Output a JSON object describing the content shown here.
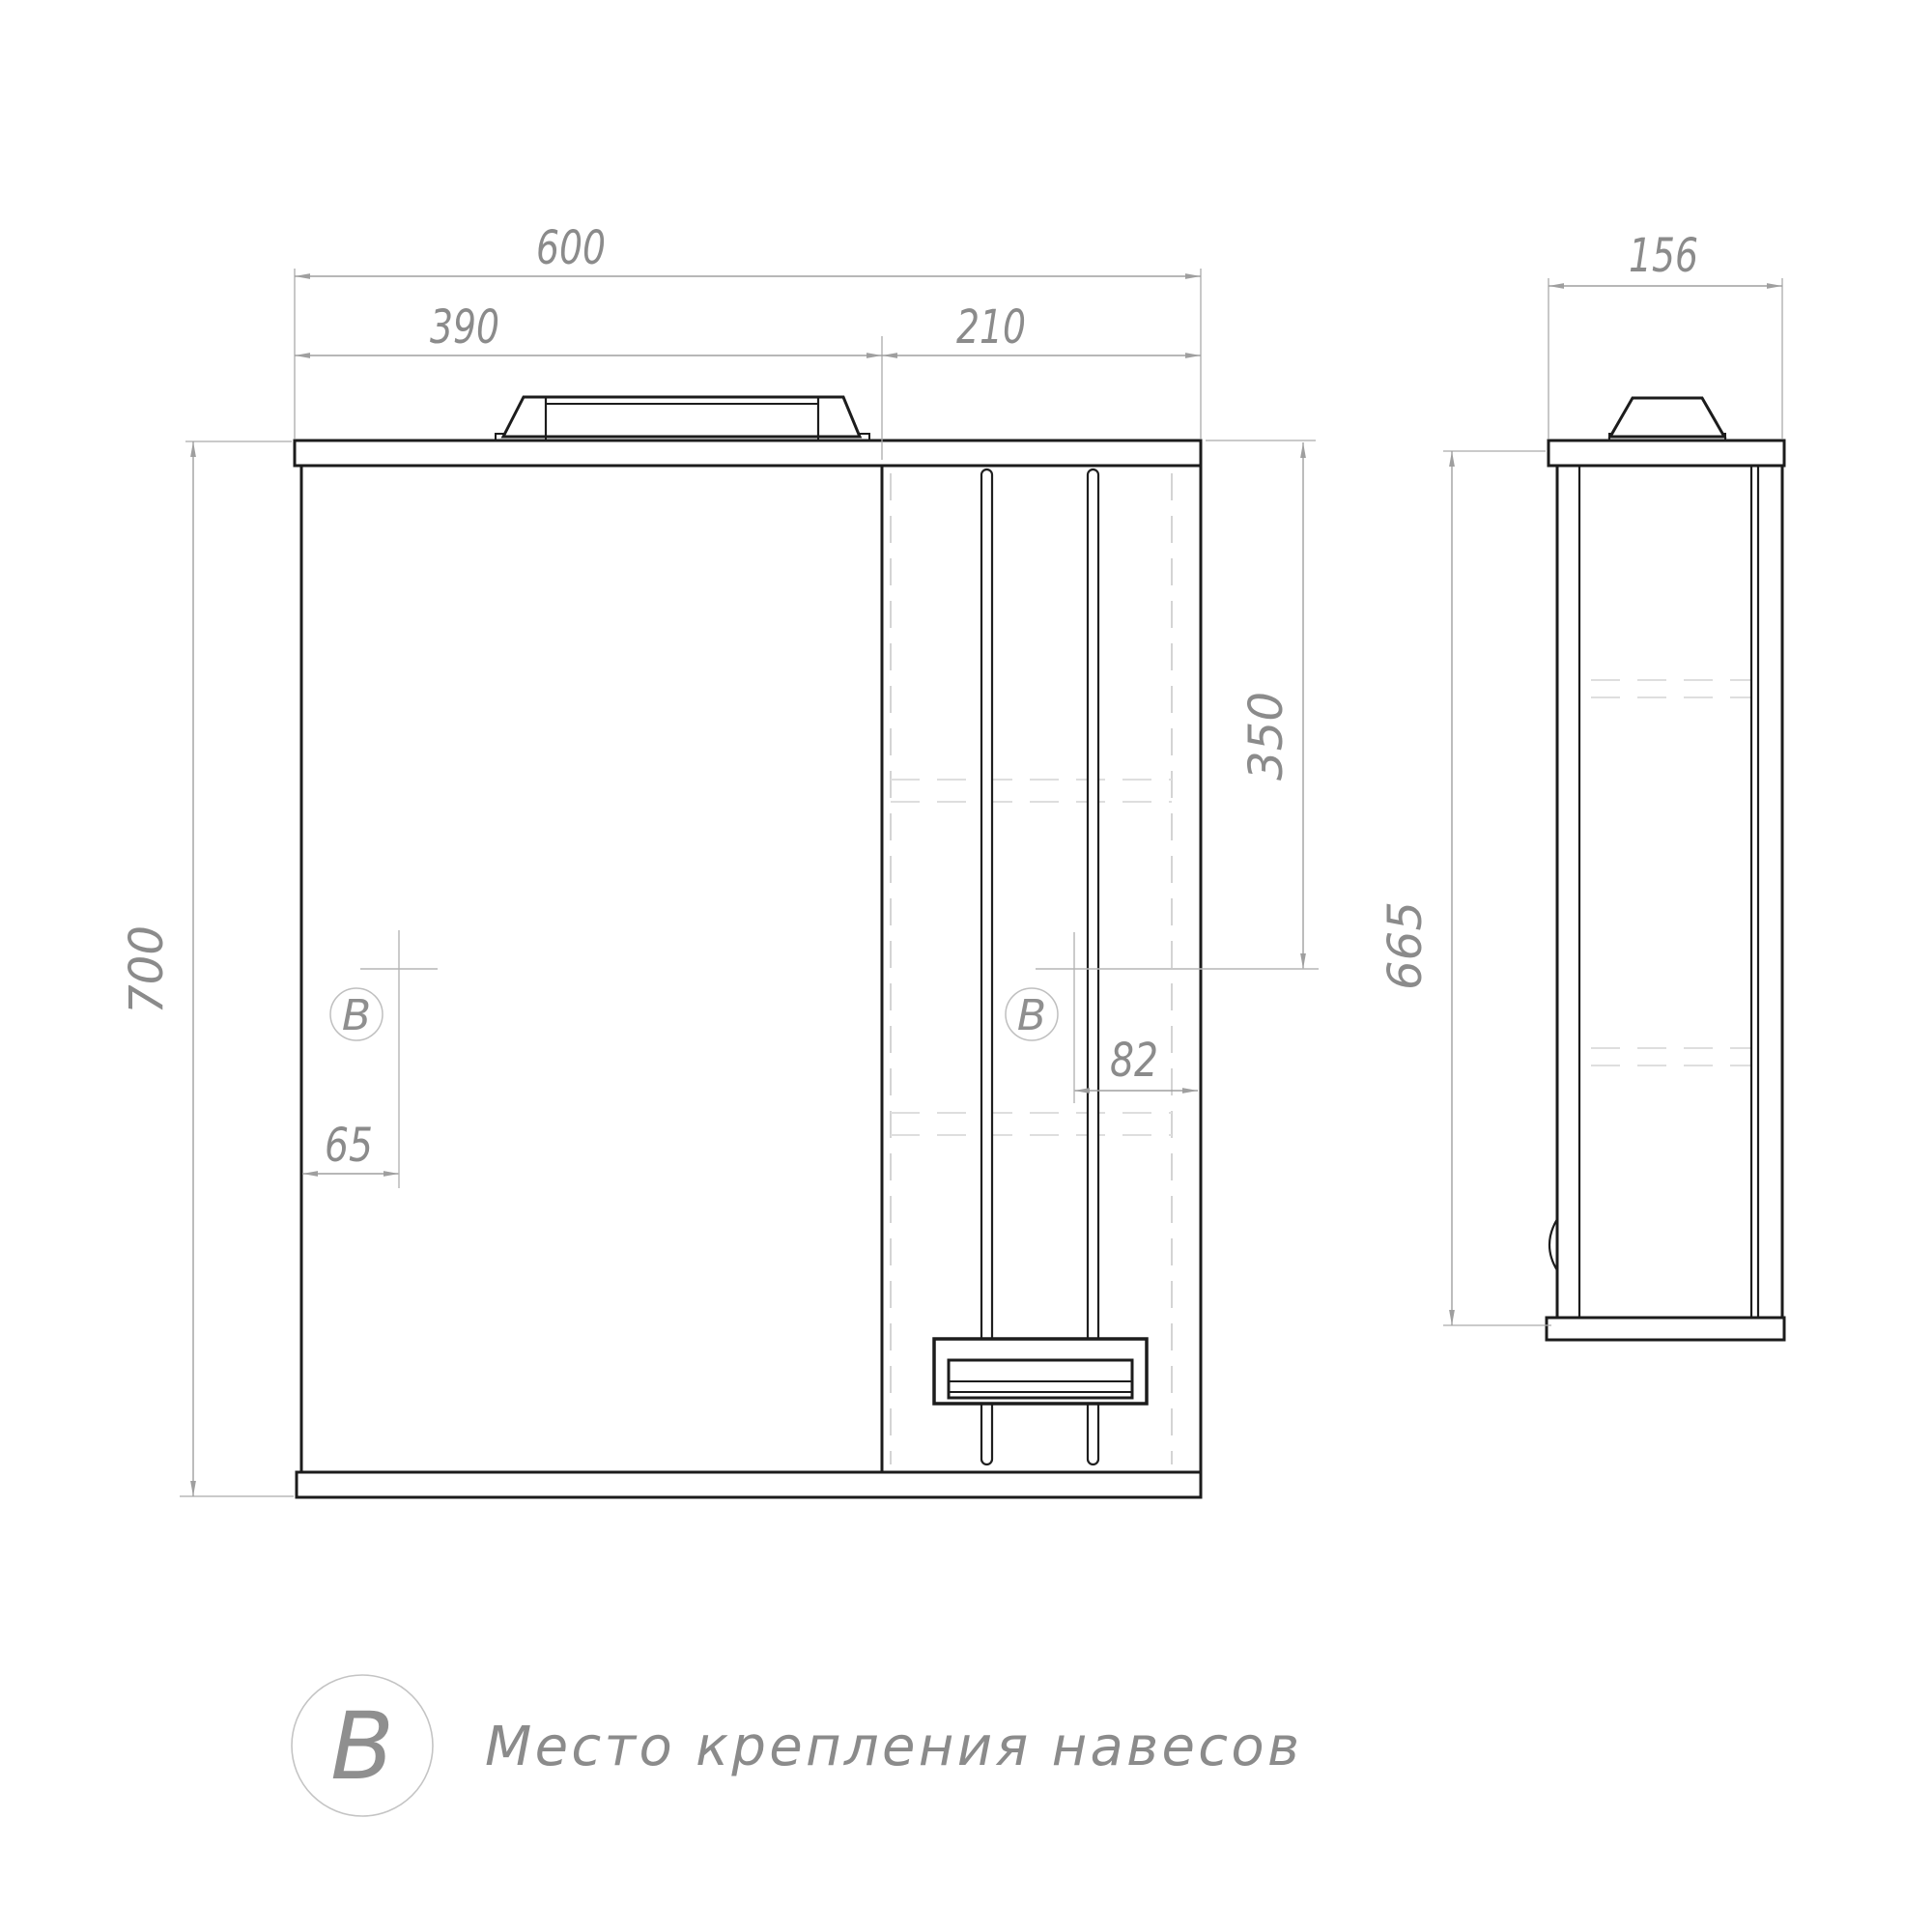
{
  "drawing": {
    "front_view": {
      "dim_width_total": "600",
      "dim_width_mirror": "390",
      "dim_width_cabinet": "210",
      "dim_height_total": "700",
      "dim_mount_from_top": "350",
      "dim_mount_offset_right": "82",
      "dim_mount_offset_left": "65",
      "marker_letter": "В"
    },
    "side_view": {
      "dim_depth": "156",
      "dim_height_body": "665"
    },
    "legend": {
      "symbol": "В",
      "description": "Место крепления навесов"
    },
    "colors": {
      "outline": "#1c1c1c",
      "dimension_text": "#8b8b8b",
      "dimension_line": "#9f9f9f",
      "hidden_line": "#d6d6d6",
      "background": "#ffffff"
    }
  }
}
